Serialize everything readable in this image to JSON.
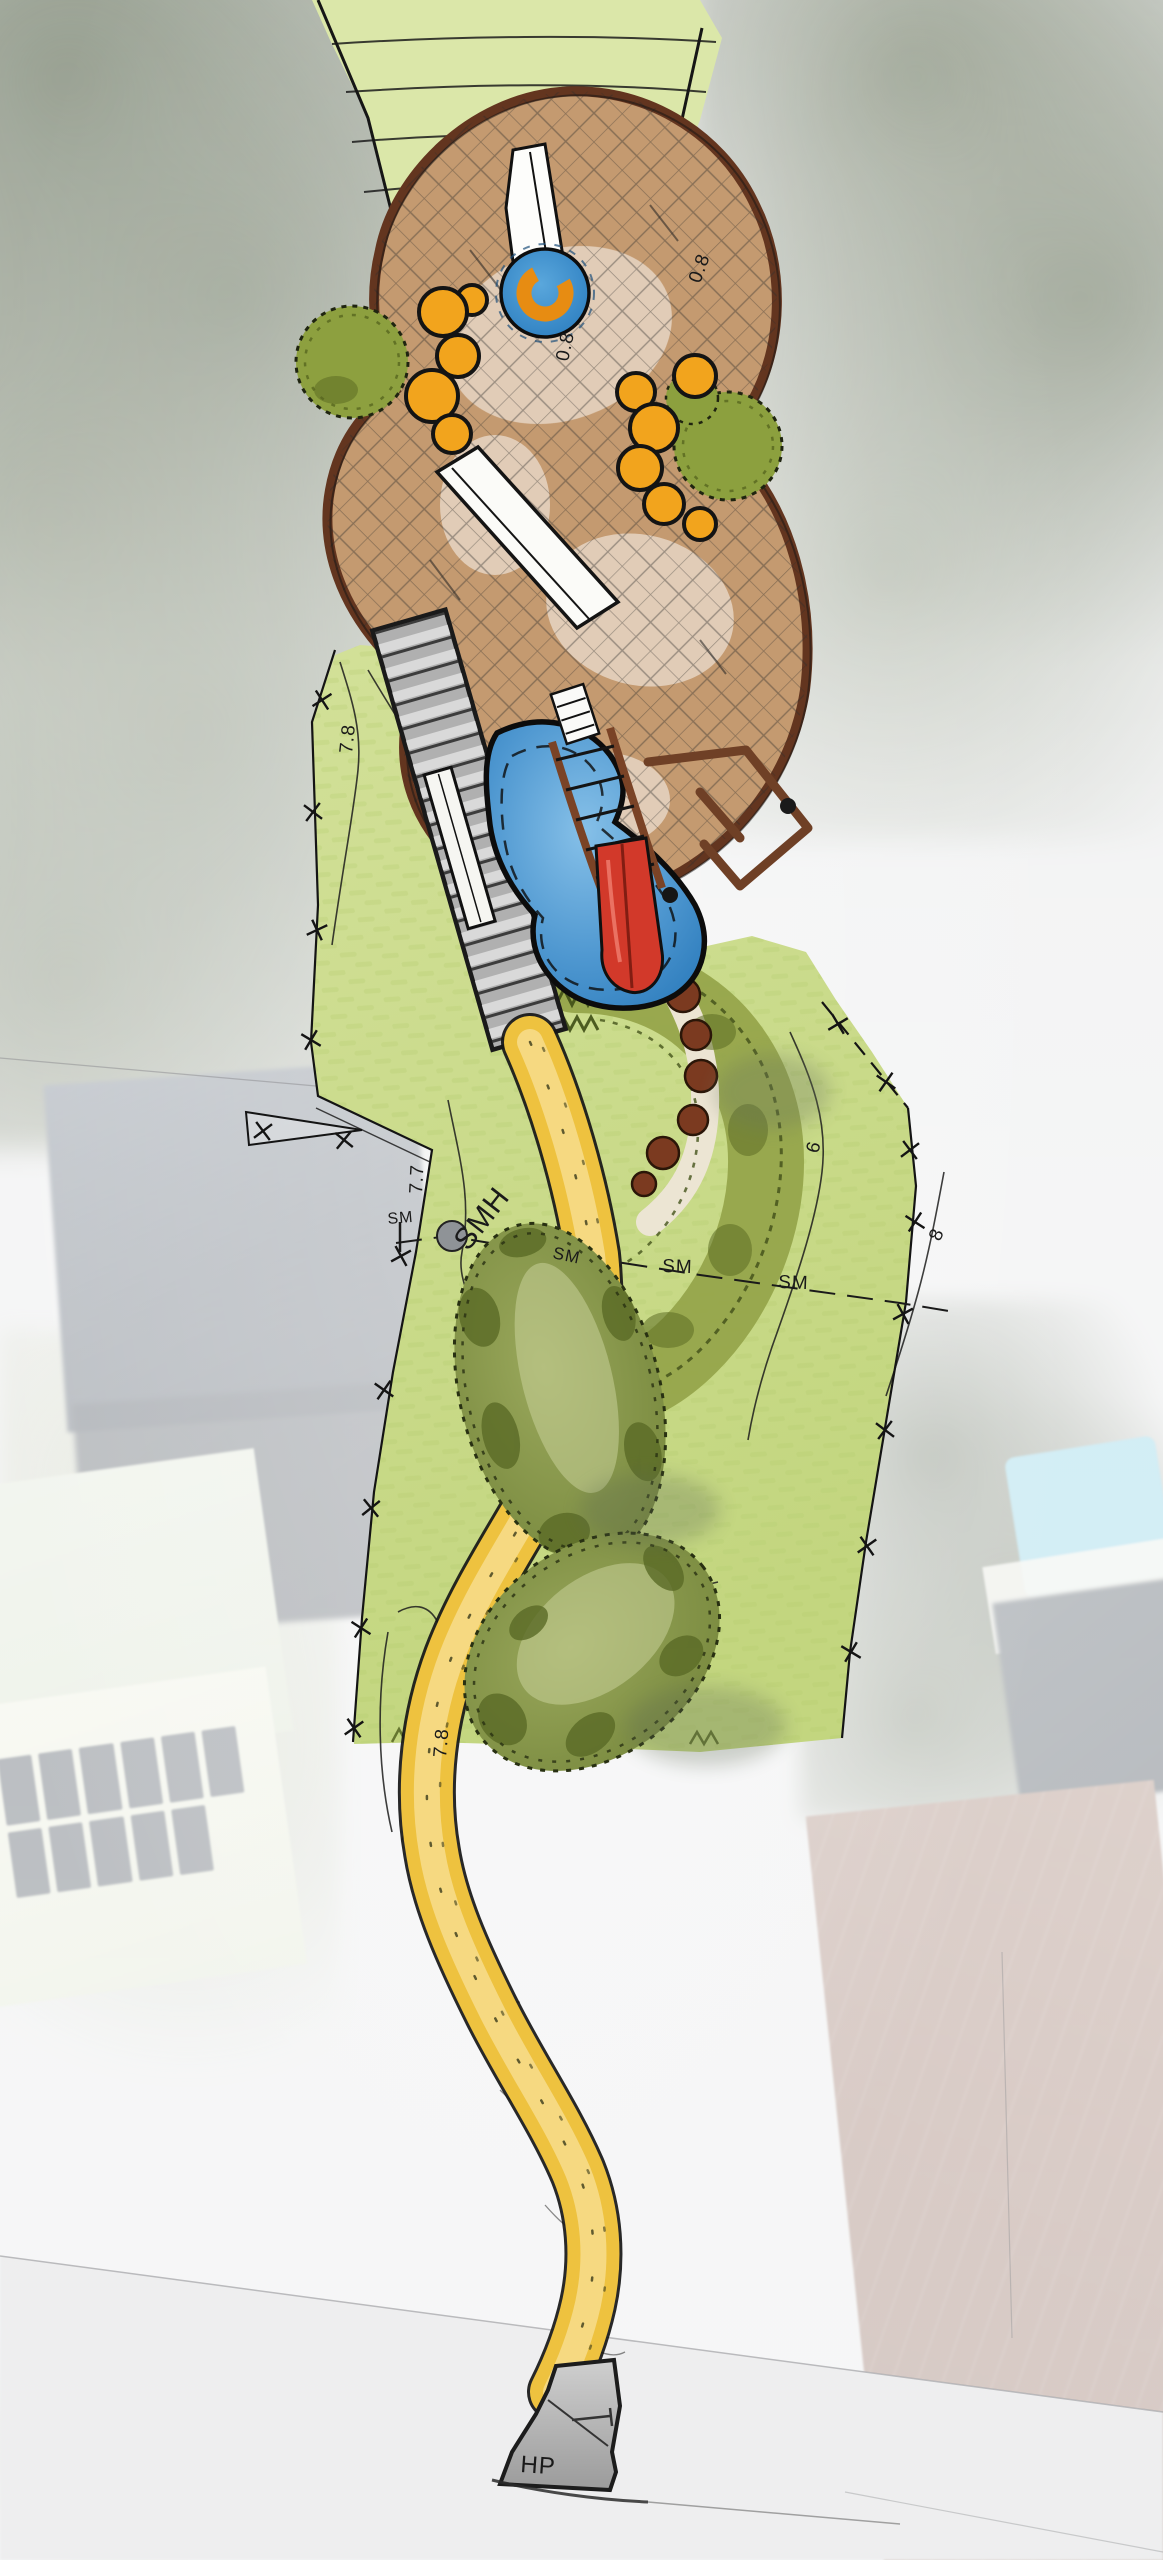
{
  "labels": {
    "sewer_manhole": "SMH",
    "sewer_main": "SM",
    "high_point": "HP"
  },
  "contours": {
    "c08": "0.8",
    "c78": "7.8",
    "c77": "7.7",
    "c6": "6",
    "c8": "8"
  },
  "palette": {
    "path_yellow": "#EEC23F",
    "path_core": "#F7DD8D",
    "pond_blue": "#2E7DBD",
    "pond_blue_light": "#7FBAE4",
    "mulch_tan": "#C49A70",
    "mulch_edge": "#63351F",
    "grass_green": "#CBDD8E",
    "hatch_grass": "#DBE7A9",
    "tree_olive": "#7F8F41",
    "garden_olive": "#96A54B",
    "shrub_orange": "#F2A41D",
    "slide_red": "#D2392A",
    "equipment_brown": "#7A4326",
    "boardwalk_grey": "#B0B0B0",
    "manhole_grey": "#8F9397",
    "apron_grey": "#B5B5B5",
    "pool_cyan": "#8FD3E6",
    "roof_redbrown": "#9A7669",
    "roof_dark": "#4A535F",
    "roof_mint": "#E0E7D7",
    "street_grey": "#D2D3D5"
  }
}
